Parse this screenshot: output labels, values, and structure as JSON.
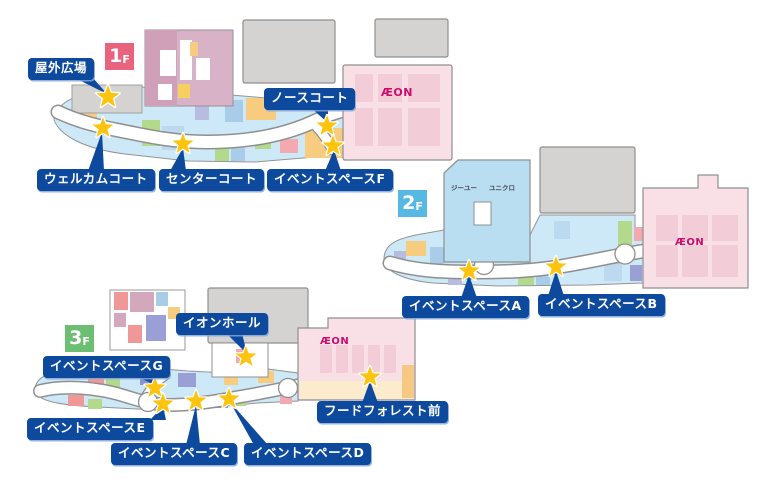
{
  "colors": {
    "label_bg": "#0d4a9e",
    "star": "#fdc40d",
    "badge_1f": "#e9637f",
    "badge_2f": "#57b9e2",
    "badge_3f": "#6cbe72",
    "aeon_logo": "#cb0c6d",
    "building_gray": "#d5d3d1",
    "aeon_building_pink": "#f8e0e6",
    "strip_blue": "#cde9f8"
  },
  "floor1": {
    "badge": {
      "number": "1",
      "suffix": "F"
    },
    "aeon_logo": "ÆON",
    "labels": {
      "outdoor_plaza": "屋外広場",
      "north_court": "ノースコート",
      "welcome_court": "ウェルカムコート",
      "center_court": "センターコート",
      "event_space_f": "イベントスペースF"
    }
  },
  "floor2": {
    "badge": {
      "number": "2",
      "suffix": "F"
    },
    "aeon_logo": "ÆON",
    "stores": {
      "gu": "ジーユー",
      "uniqlo": "ユニクロ"
    },
    "labels": {
      "event_space_a": "イベントスペースA",
      "event_space_b": "イベントスペースB"
    }
  },
  "floor3": {
    "badge": {
      "number": "3",
      "suffix": "F"
    },
    "aeon_logo": "ÆON",
    "labels": {
      "aeon_hall": "イオンホール",
      "event_space_g": "イベントスペースG",
      "event_space_e": "イベントスペースE",
      "event_space_c": "イベントスペースC",
      "event_space_d": "イベントスペースD",
      "food_forest_mae": "フードフォレスト前"
    }
  }
}
